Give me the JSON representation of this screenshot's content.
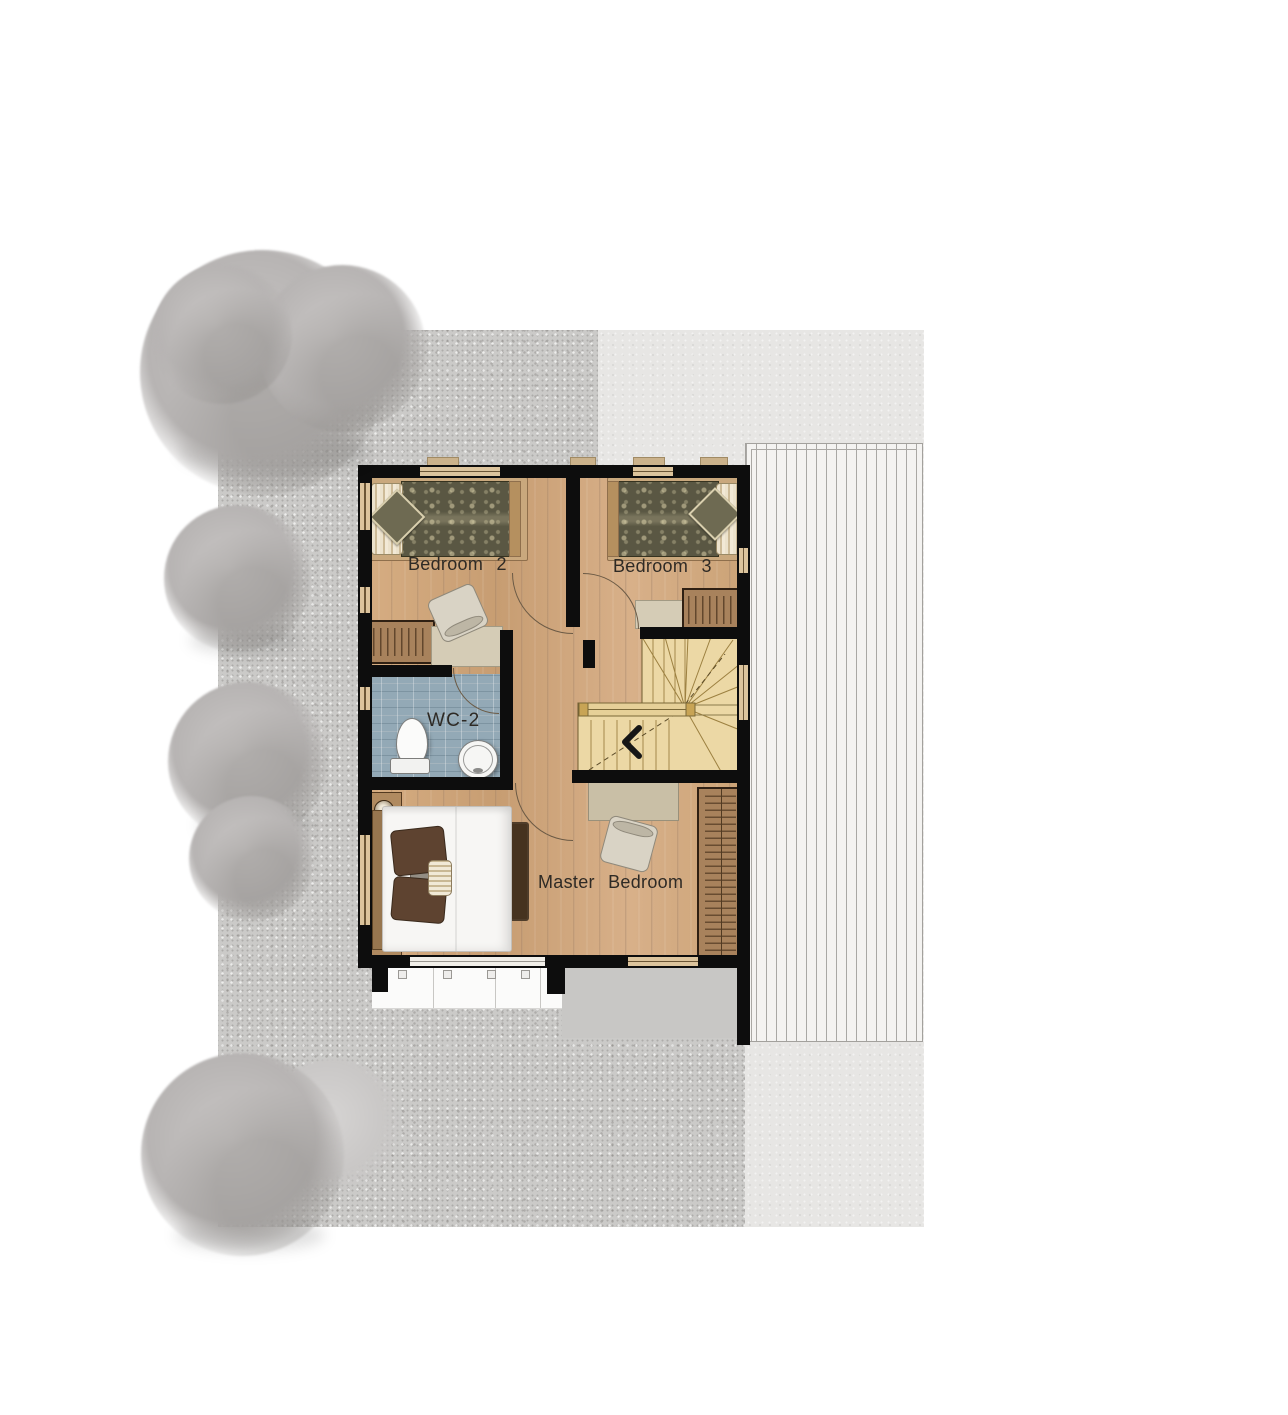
{
  "plan": {
    "type": "residential second-floor plan",
    "labels": {
      "bedroom2": "Bedroom 2",
      "bedroom3": "Bedroom 3",
      "wc2": "WC-2",
      "master_bedroom": "Master Bedroom"
    },
    "rooms": [
      {
        "id": "bedroom2",
        "name": "Bedroom 2",
        "features": [
          "single-bed",
          "wardrobe",
          "dresser",
          "chair",
          "windows"
        ]
      },
      {
        "id": "bedroom3",
        "name": "Bedroom 3",
        "features": [
          "single-bed",
          "wardrobe",
          "dresser",
          "windows"
        ]
      },
      {
        "id": "wc2",
        "name": "WC-2",
        "features": [
          "toilet",
          "sink",
          "tiled-floor",
          "door"
        ]
      },
      {
        "id": "master_bedroom",
        "name": "Master Bedroom",
        "features": [
          "double-bed",
          "nightstands",
          "lamps",
          "rug",
          "desk",
          "chair",
          "wardrobe",
          "balcony-below"
        ]
      },
      {
        "id": "stair",
        "name": "winder staircase",
        "features": [
          "u-turn-winder",
          "railing",
          "direction-arrow"
        ]
      }
    ],
    "site": {
      "ground": "gravel texture",
      "paving_right": "smooth light paving",
      "deck": "slatted deck / lower roof with vertical boards",
      "trees": 7
    },
    "colors": {
      "wall": "#0d0d0d",
      "wood_floor": "#d0a77c",
      "stair_wood": "#ecd8a5",
      "bathroom_tile": "#93a9b6",
      "wardrobe_brown": "#a8825c",
      "dresser_beige": "#d5ccb6",
      "duvet_olive": "#5a5743",
      "site_gravel": "#cbcac8",
      "paving_light": "#e7e6e4",
      "deck_white": "#f4f3f1",
      "tree_gray": "#b7b4b3",
      "label_text": "#2e2a25"
    }
  }
}
